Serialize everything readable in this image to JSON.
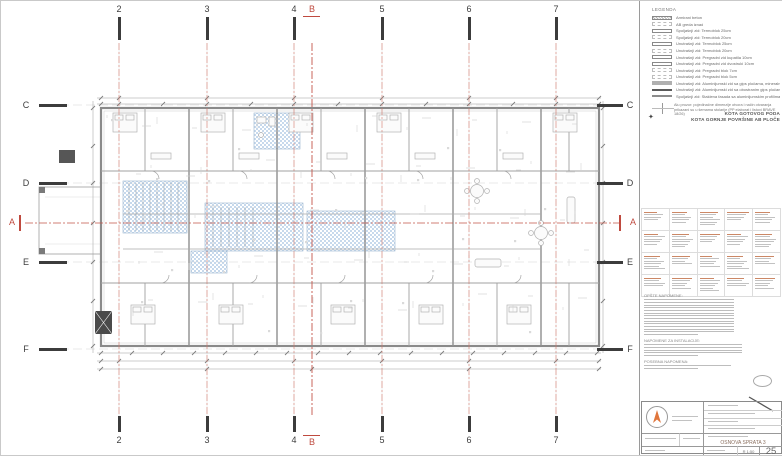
{
  "drawing": {
    "grid": {
      "columns": [
        "2",
        "3",
        "4",
        "5",
        "6",
        "7"
      ],
      "rows": [
        "C",
        "D",
        "E",
        "F"
      ],
      "section_a": "A",
      "section_b": "B"
    }
  },
  "panel": {
    "legend": {
      "title": "LEGENDA",
      "items": [
        {
          "style": "concrete",
          "label": "Armirani beton"
        },
        {
          "style": "dash",
          "label": "AB greda iznad"
        },
        {
          "style": "outline",
          "label": "Spoljašnji zid: Termoblok 25cm"
        },
        {
          "style": "dash",
          "label": "Spoljašnji zid: Termoblok 20cm"
        },
        {
          "style": "outline",
          "label": "Unutrašnji zid: Termoblok 25cm"
        },
        {
          "style": "dash",
          "label": "Unutrašnji zid: Termoblok 20cm"
        },
        {
          "style": "outline",
          "label": "Unutrašnji zid: Pregradni zid kupatila 10cm"
        },
        {
          "style": "outline",
          "label": "Unutrašnji zid: Pregradni zid dvostruki 10cm"
        },
        {
          "style": "dash",
          "label": "Unutrašnji zid: Pregradni blok 7cm"
        },
        {
          "style": "dash",
          "label": "Unutrašnji zid: Pregradni blok 5cm"
        },
        {
          "style": "grayfill",
          "label": "Unutrašnji zid: Aluminijumski zid sa gips pločama, mineralna vuna 10 cm"
        },
        {
          "style": "darkfill",
          "label": "Unutrašnji zid: Aluminijumski zid sa obostranim gips pločama sa zvučnom izolacijom"
        },
        {
          "style": "midfill",
          "label": "Spoljašnji zid: Staklena fasada sa aluminijumskim profilima"
        }
      ],
      "note": "Alu prozor: pojedinačne dimenzije otvora i način otvaranja prikazani su u šemama stolarije (PP elaborat i listovi BRAVE 18/26)"
    },
    "kota": {
      "line1": "KOTA GOTOVOG PODA",
      "line2": "KOTA GORNJE POVRŠINE AB PLOČE",
      "symbol": "level-mark"
    },
    "notes": {
      "heading": "OPŠTE NAPOMENE:",
      "subheading": "NAPOMENE ZA INSTALACIJE:",
      "footer_heading": "POSEBNA NAPOMENA:"
    },
    "titleblock": {
      "drawing_title": "OSNOVA SPRATA 3",
      "scale": "R 1:50",
      "sheet_number": "25"
    }
  }
}
